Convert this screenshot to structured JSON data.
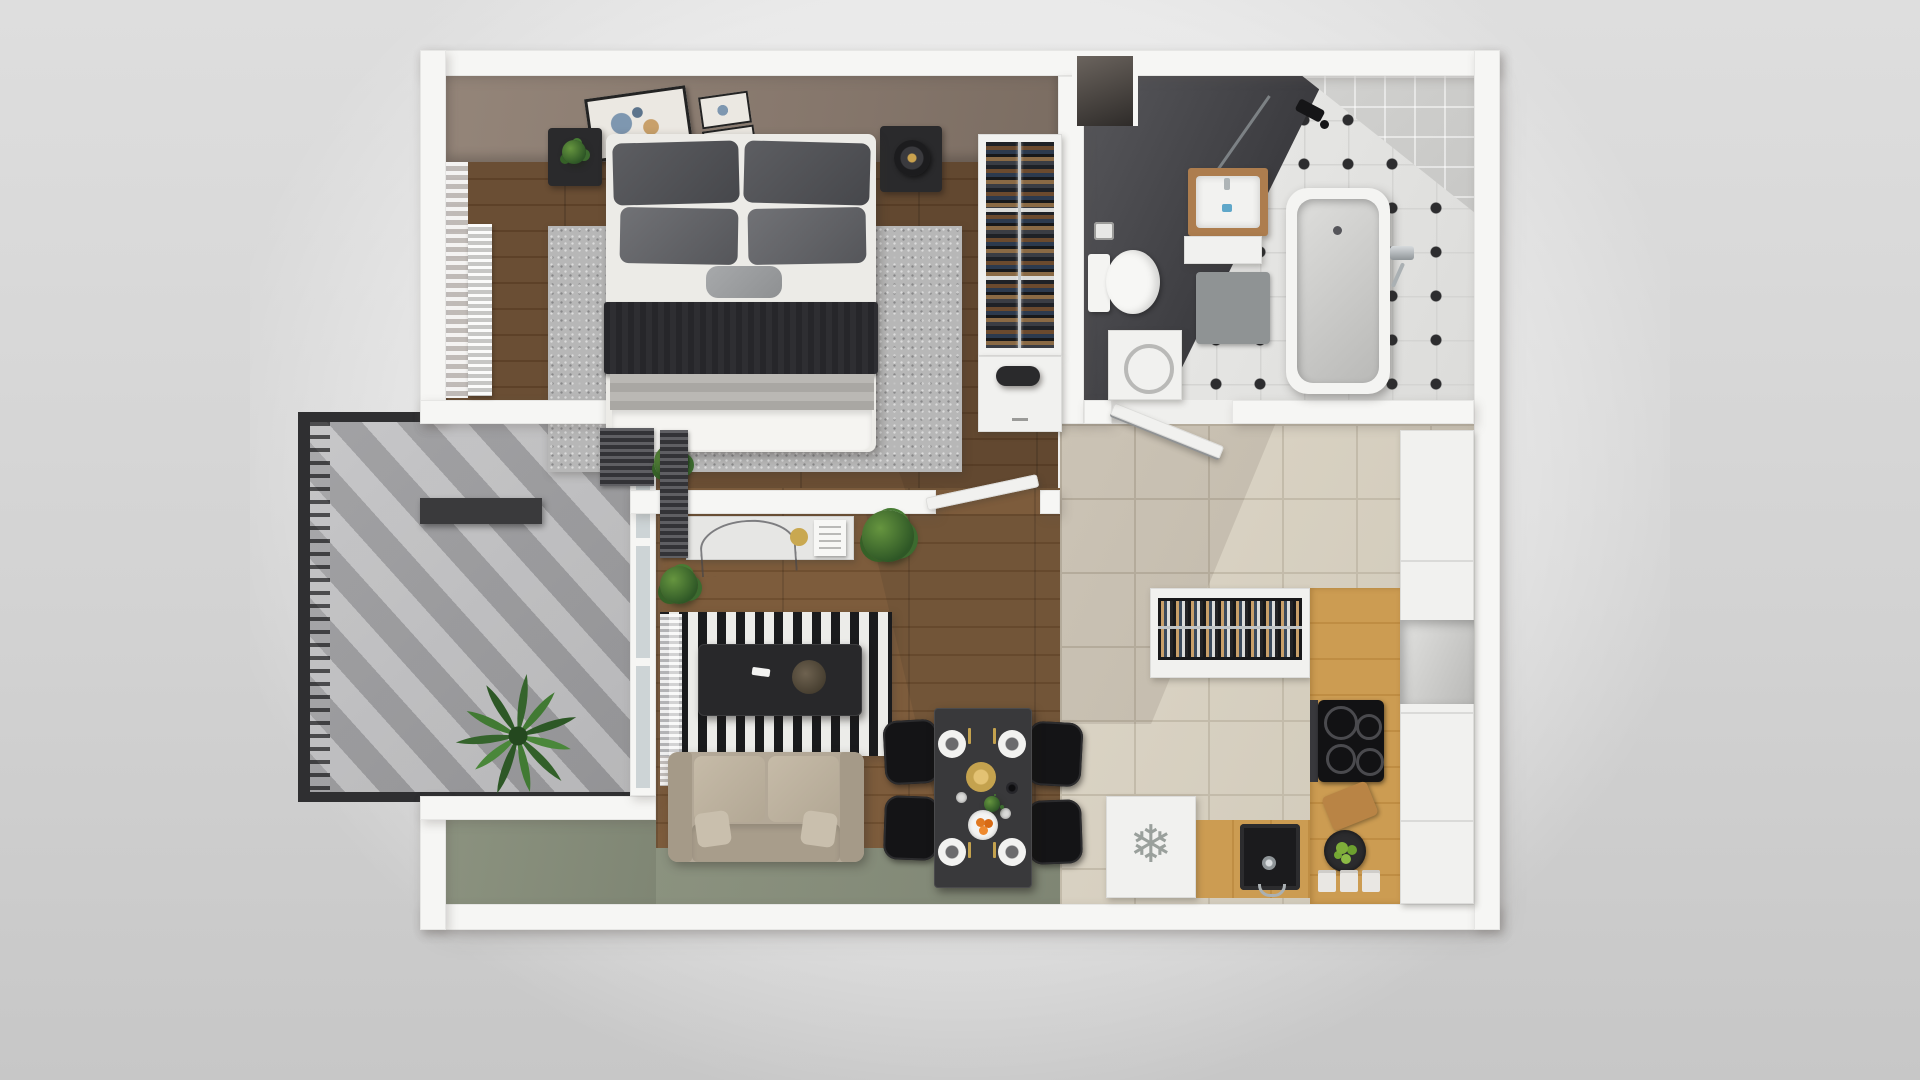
{
  "scene": {
    "type": "3d-floor-plan-render-top-down",
    "rooms": [
      {
        "id": "bedroom",
        "floor": "dark-wood",
        "furniture": [
          "double-bed",
          "pillows",
          "throw-blanket",
          "nightstand-left",
          "nightstand-right",
          "table-lamp",
          "wall-art-frames",
          "gray-area-rug",
          "sheer-curtain",
          "white-radiator",
          "dark-radiator",
          "potted-plant"
        ]
      },
      {
        "id": "wardrobe-nook",
        "furniture": [
          "open-wardrobe-hanging-clothes",
          "clothes-rail",
          "low-cabinet",
          "decor-tray"
        ]
      },
      {
        "id": "entry",
        "furniture": [
          "entry-door-niche"
        ]
      },
      {
        "id": "bathroom",
        "floor": "octagon-tiles",
        "furniture": [
          "bathtub",
          "tub-mixer-handshower",
          "shower-head",
          "glass-screen",
          "sink-vanity-wood",
          "vanity-cabinet",
          "toilet",
          "toilet-paper-holder",
          "washing-machine",
          "bath-mat",
          "dark-accent-wall"
        ]
      },
      {
        "id": "kitchen",
        "floor": "beige-tiles",
        "furniture": [
          "tall-cabinets",
          "open-niche",
          "island-counter",
          "plate-drawer",
          "wood-countertop",
          "induction-cooktop",
          "oven",
          "cutting-board",
          "apple-bowl",
          "storage-jars",
          "black-sink",
          "faucet",
          "freezer"
        ]
      },
      {
        "id": "dining",
        "furniture": [
          "black-table",
          "chairs-x4",
          "white-plates",
          "gold-cutlery",
          "gold-charger",
          "orange-fruit-bowl",
          "bottle",
          "glasses",
          "mini-plant"
        ]
      },
      {
        "id": "living-room",
        "floor": "wood-and-green-carpet",
        "furniture": [
          "striped-rug",
          "coffee-table",
          "remote",
          "decor-bowl",
          "sofa",
          "console-desk",
          "glass-chair",
          "gold-plate",
          "magazine",
          "floor-plant",
          "dark-radiator",
          "white-blind"
        ]
      },
      {
        "id": "balcony",
        "floor": "concrete",
        "furniture": [
          "metal-railing",
          "privacy-screen",
          "palm-plant",
          "glazed-wall"
        ]
      }
    ]
  },
  "icons": {
    "freezer_snowflake": "❄"
  },
  "palette": {
    "background": "#d3d3d3",
    "wall": "#f6f6f4",
    "bedroom_wall_face": "#86776c",
    "wood_dark": "#5d4128",
    "wood_light": "#6f4f30",
    "green_carpet": "#868d7b",
    "kitchen_tile": "#d4cdbd",
    "bath_tile": "#e6e6e4",
    "accent_dark": "#3b3b3f",
    "counter_wood": "#c9984f",
    "apple_green": "#7fae3a",
    "gold": "#c4a24e"
  }
}
